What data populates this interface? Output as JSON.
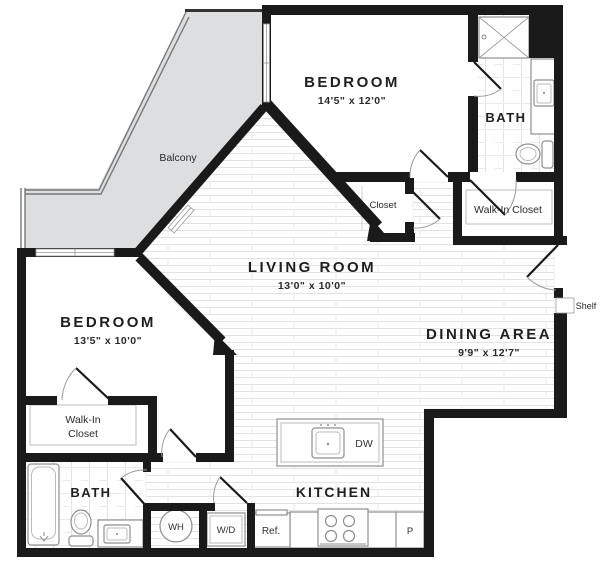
{
  "plan": {
    "rooms": {
      "bedroom_top": {
        "label": "BEDROOM",
        "dims": "14'5\" x 12'0\""
      },
      "bedroom_left": {
        "label": "BEDROOM",
        "dims": "13'5\" x 10'0\""
      },
      "living": {
        "label": "LIVING ROOM",
        "dims": "13'0\" x 10'0\""
      },
      "dining": {
        "label": "DINING AREA",
        "dims": "9'9\" x 12'7\""
      },
      "kitchen": {
        "label": "KITCHEN"
      },
      "bath_top": {
        "label": "BATH"
      },
      "bath_bottom": {
        "label": "BATH"
      },
      "balcony": {
        "label": "Balcony"
      },
      "closet": {
        "label": "Closet"
      },
      "walkin_top": {
        "label": "Walk-In Closet"
      },
      "walkin_left": {
        "line1": "Walk-In",
        "line2": "Closet"
      },
      "shelf": {
        "label": "Shelf"
      }
    },
    "fixtures": {
      "water_heater": "WH",
      "washer_dryer": "W/D",
      "refrigerator": "Ref.",
      "dishwasher": "DW",
      "pantry": "P"
    },
    "colors": {
      "wall": "#1a1a1a",
      "balcony_fill": "#dcdee0",
      "fixture_line": "#8f8f8f",
      "text": "#1f1f1f"
    }
  }
}
